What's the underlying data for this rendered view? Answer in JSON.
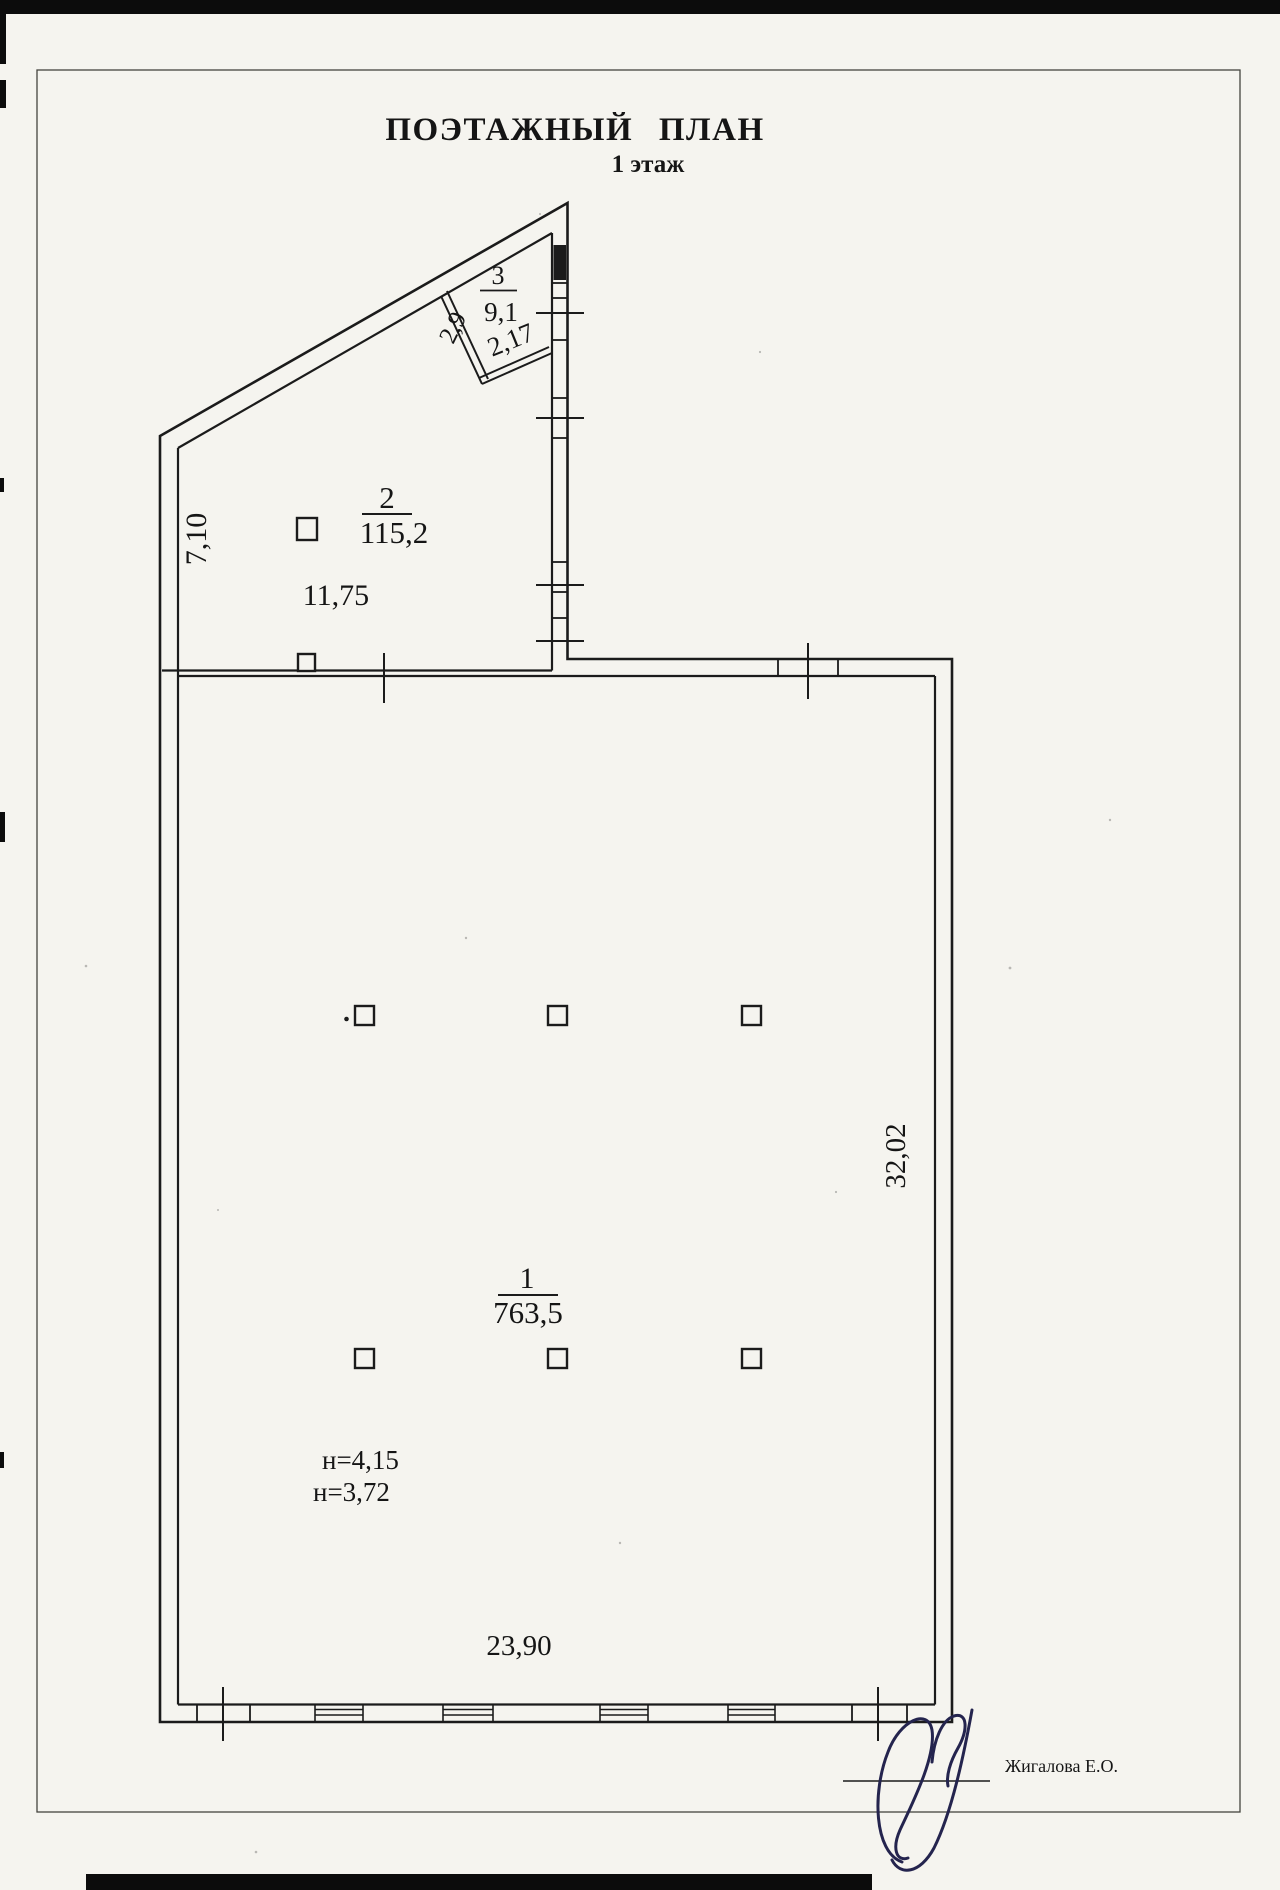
{
  "document": {
    "title": "ПОЭТАЖНЫЙ ПЛАН",
    "floor_label": "1 этаж"
  },
  "rooms": {
    "room1": {
      "number": "1",
      "area": "763,5",
      "height_note_1": "н=4,15",
      "height_note_2": "н=3,72",
      "width_dim": "23,90",
      "depth_dim": "32,02"
    },
    "room2": {
      "number": "2",
      "area": "115,2",
      "width_dim": "11,75",
      "depth_dim": "7,10"
    },
    "room3": {
      "number": "3",
      "area": "9,1",
      "width_dim": "2,17",
      "side_dim": "2,9"
    }
  },
  "signature": {
    "name": "Жигалова Е.О."
  },
  "colors": {
    "ink": "#1b1b1b",
    "paper": "#f5f4ef",
    "signature_ink": "#24244e"
  }
}
